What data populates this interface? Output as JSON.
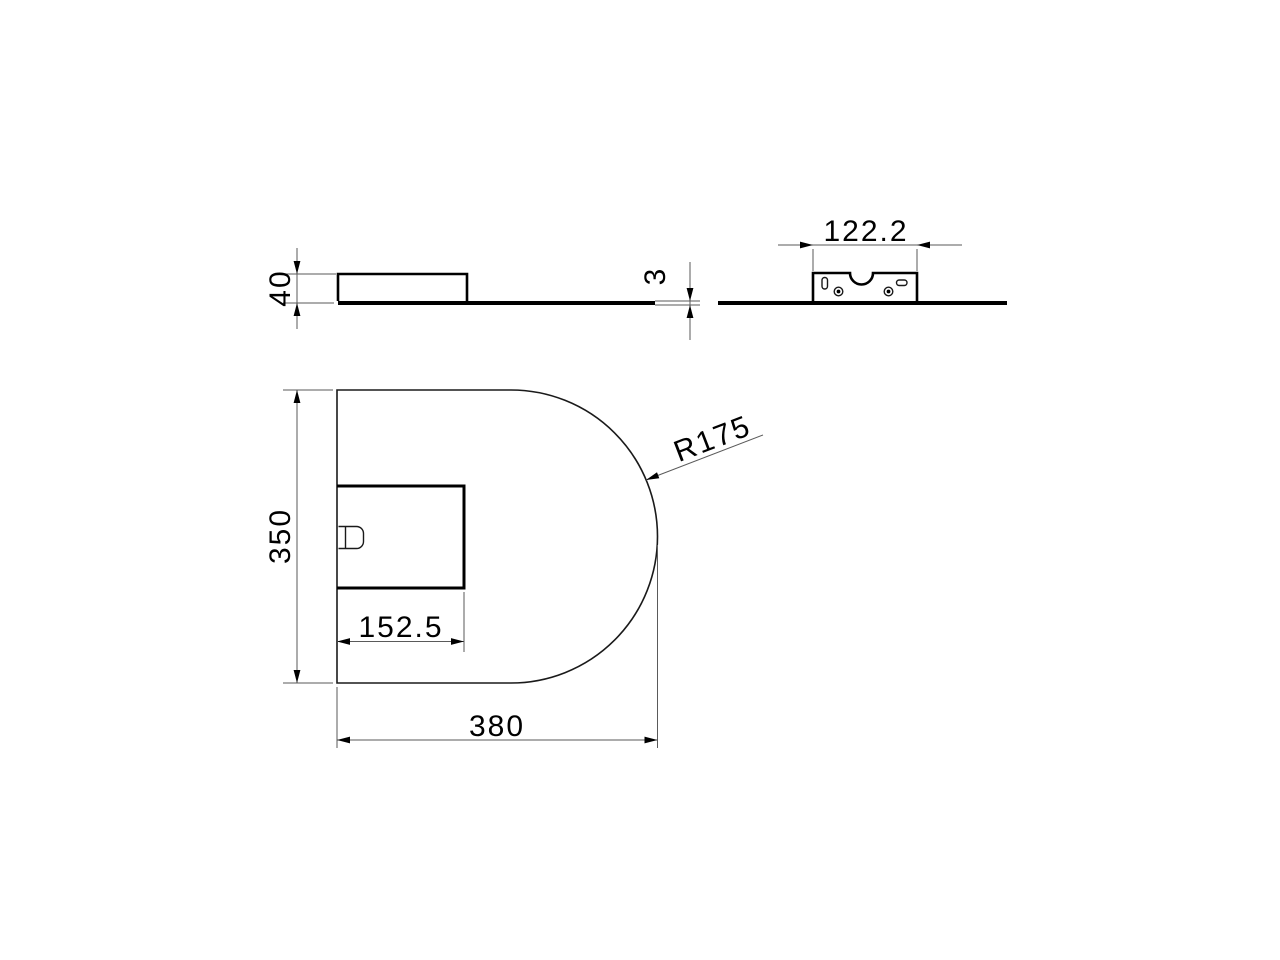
{
  "drawing": {
    "type": "technical-dimension-drawing",
    "background_color": "#ffffff",
    "line_color": "#000000",
    "dim_line_color": "#5a5a5a"
  },
  "views": {
    "side_elevation": {
      "dims": {
        "height": "40",
        "base_thickness": "3"
      }
    },
    "rear_elevation": {
      "dims": {
        "bracket_width": "122.2"
      }
    },
    "plan": {
      "dims": {
        "depth": "350",
        "cutout_width": "152.5",
        "width": "380",
        "radius": "R175"
      }
    }
  }
}
